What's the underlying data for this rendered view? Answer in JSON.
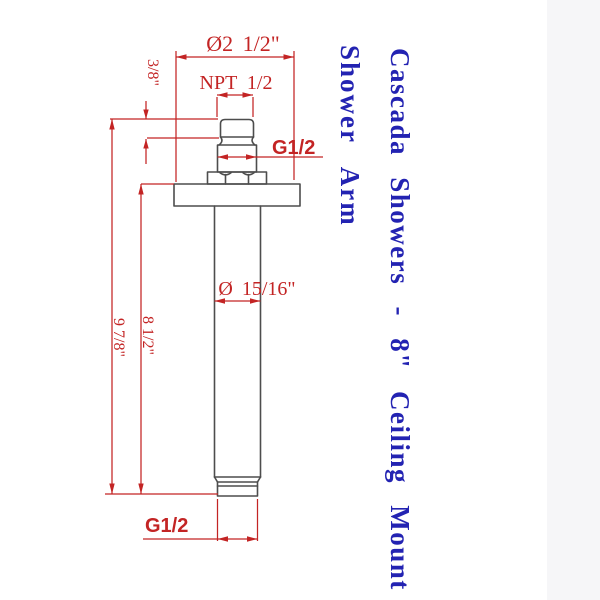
{
  "title": {
    "line1": "Cascada Showers - 8\" Ceiling Mount",
    "line2": "Shower Arm"
  },
  "dims": {
    "flange_diameter": "Ø2 1/2\"",
    "npt_thread": "NPT 1/2",
    "thread_length": "3/8\"",
    "g_thread_top": "G1/2",
    "pipe_diameter": "Ø 15/16\"",
    "overall_length": "9 7/8\"",
    "arm_length": "8 1/2\"",
    "g_thread_bottom": "G1/2"
  },
  "colors": {
    "dimension_red": "#c32424",
    "outline_gray": "#4d4d4d",
    "title_blue": "#2323b2",
    "paper": "#ffffff"
  }
}
